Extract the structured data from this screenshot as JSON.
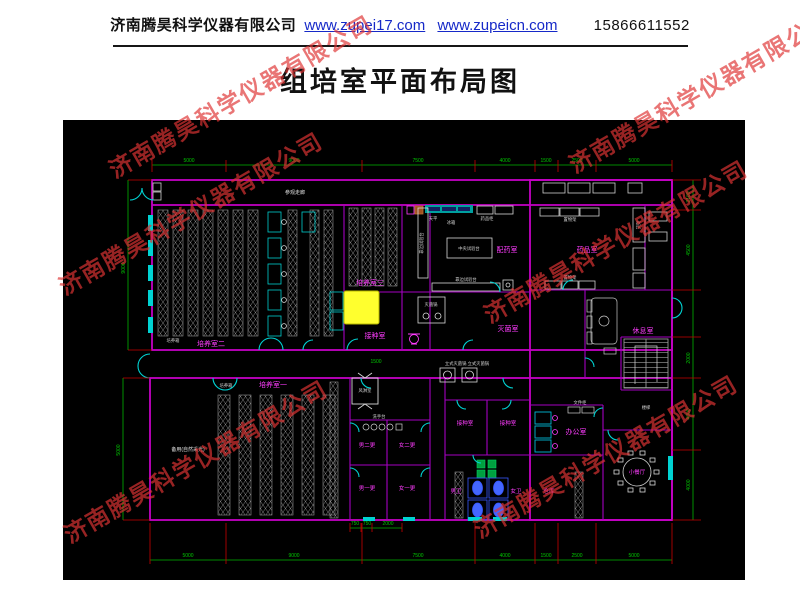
{
  "header": {
    "company": "济南腾昊科学仪器有限公司",
    "url1": "www.zupei17.com",
    "url2": "www.zupeicn.com",
    "phone": "15866611552"
  },
  "title": "组培室平面布局图",
  "watermark": {
    "text": "济南腾昊科学仪器有限公司",
    "color": "#de3434"
  },
  "plan": {
    "highlight_color": "#ffff2e",
    "labels": {
      "corridor": "参观走廊",
      "room2": "培养室二",
      "room3": "培养室三",
      "room1": "培养室一",
      "inoculation_main": "接种室",
      "media_prep": "配药室",
      "sterilization": "灭菌室",
      "medicine_store": "药品室",
      "lounge": "休息室",
      "spare": "备用(自然采光)",
      "mens_change2": "男二更",
      "womens_change2": "女二更",
      "mens_change1": "男一更",
      "womens_change1": "女一更",
      "inoculation_a": "接种室",
      "inoculation_b": "接种室",
      "mens_wc": "男卫",
      "womens_wc": "女卫",
      "storage": "仓库",
      "office": "办公室",
      "dining": "小餐厅",
      "air_shower": "风淋室",
      "wash_station": "洗手台",
      "stairs": "楼梯"
    },
    "equipment": {
      "incubator": "培养箱",
      "incubator2": "培养箱",
      "balance": "天平",
      "fridge": "冰箱",
      "medicine_cabinet": "药品柜",
      "central_bench": "中央试验台",
      "side_bench": "靠边试验台",
      "side_bench_v": "靠边试验台",
      "autoclave": "灭菌锅",
      "vertical_autoclaves": "立式灭菌锅 立式灭菌锅",
      "shelf_top": "置物架",
      "shelf_bottom": "置物架",
      "rack_shelf": "货架",
      "file_cabinet": "文件柜"
    },
    "dims": {
      "top": [
        "5000",
        "9000",
        "7500",
        "4000",
        "1500",
        "2500",
        "5000"
      ],
      "bottom": [
        "5000",
        "9000",
        "7500",
        "4000",
        "1500",
        "2500",
        "5000"
      ],
      "bottom_sub": [
        "750",
        "750",
        "2000"
      ],
      "left_upper": "9000",
      "left_lower": "5000",
      "right": [
        "2100",
        "4500",
        "2000",
        "4000",
        "4000"
      ],
      "corridor_width": "1500"
    }
  }
}
